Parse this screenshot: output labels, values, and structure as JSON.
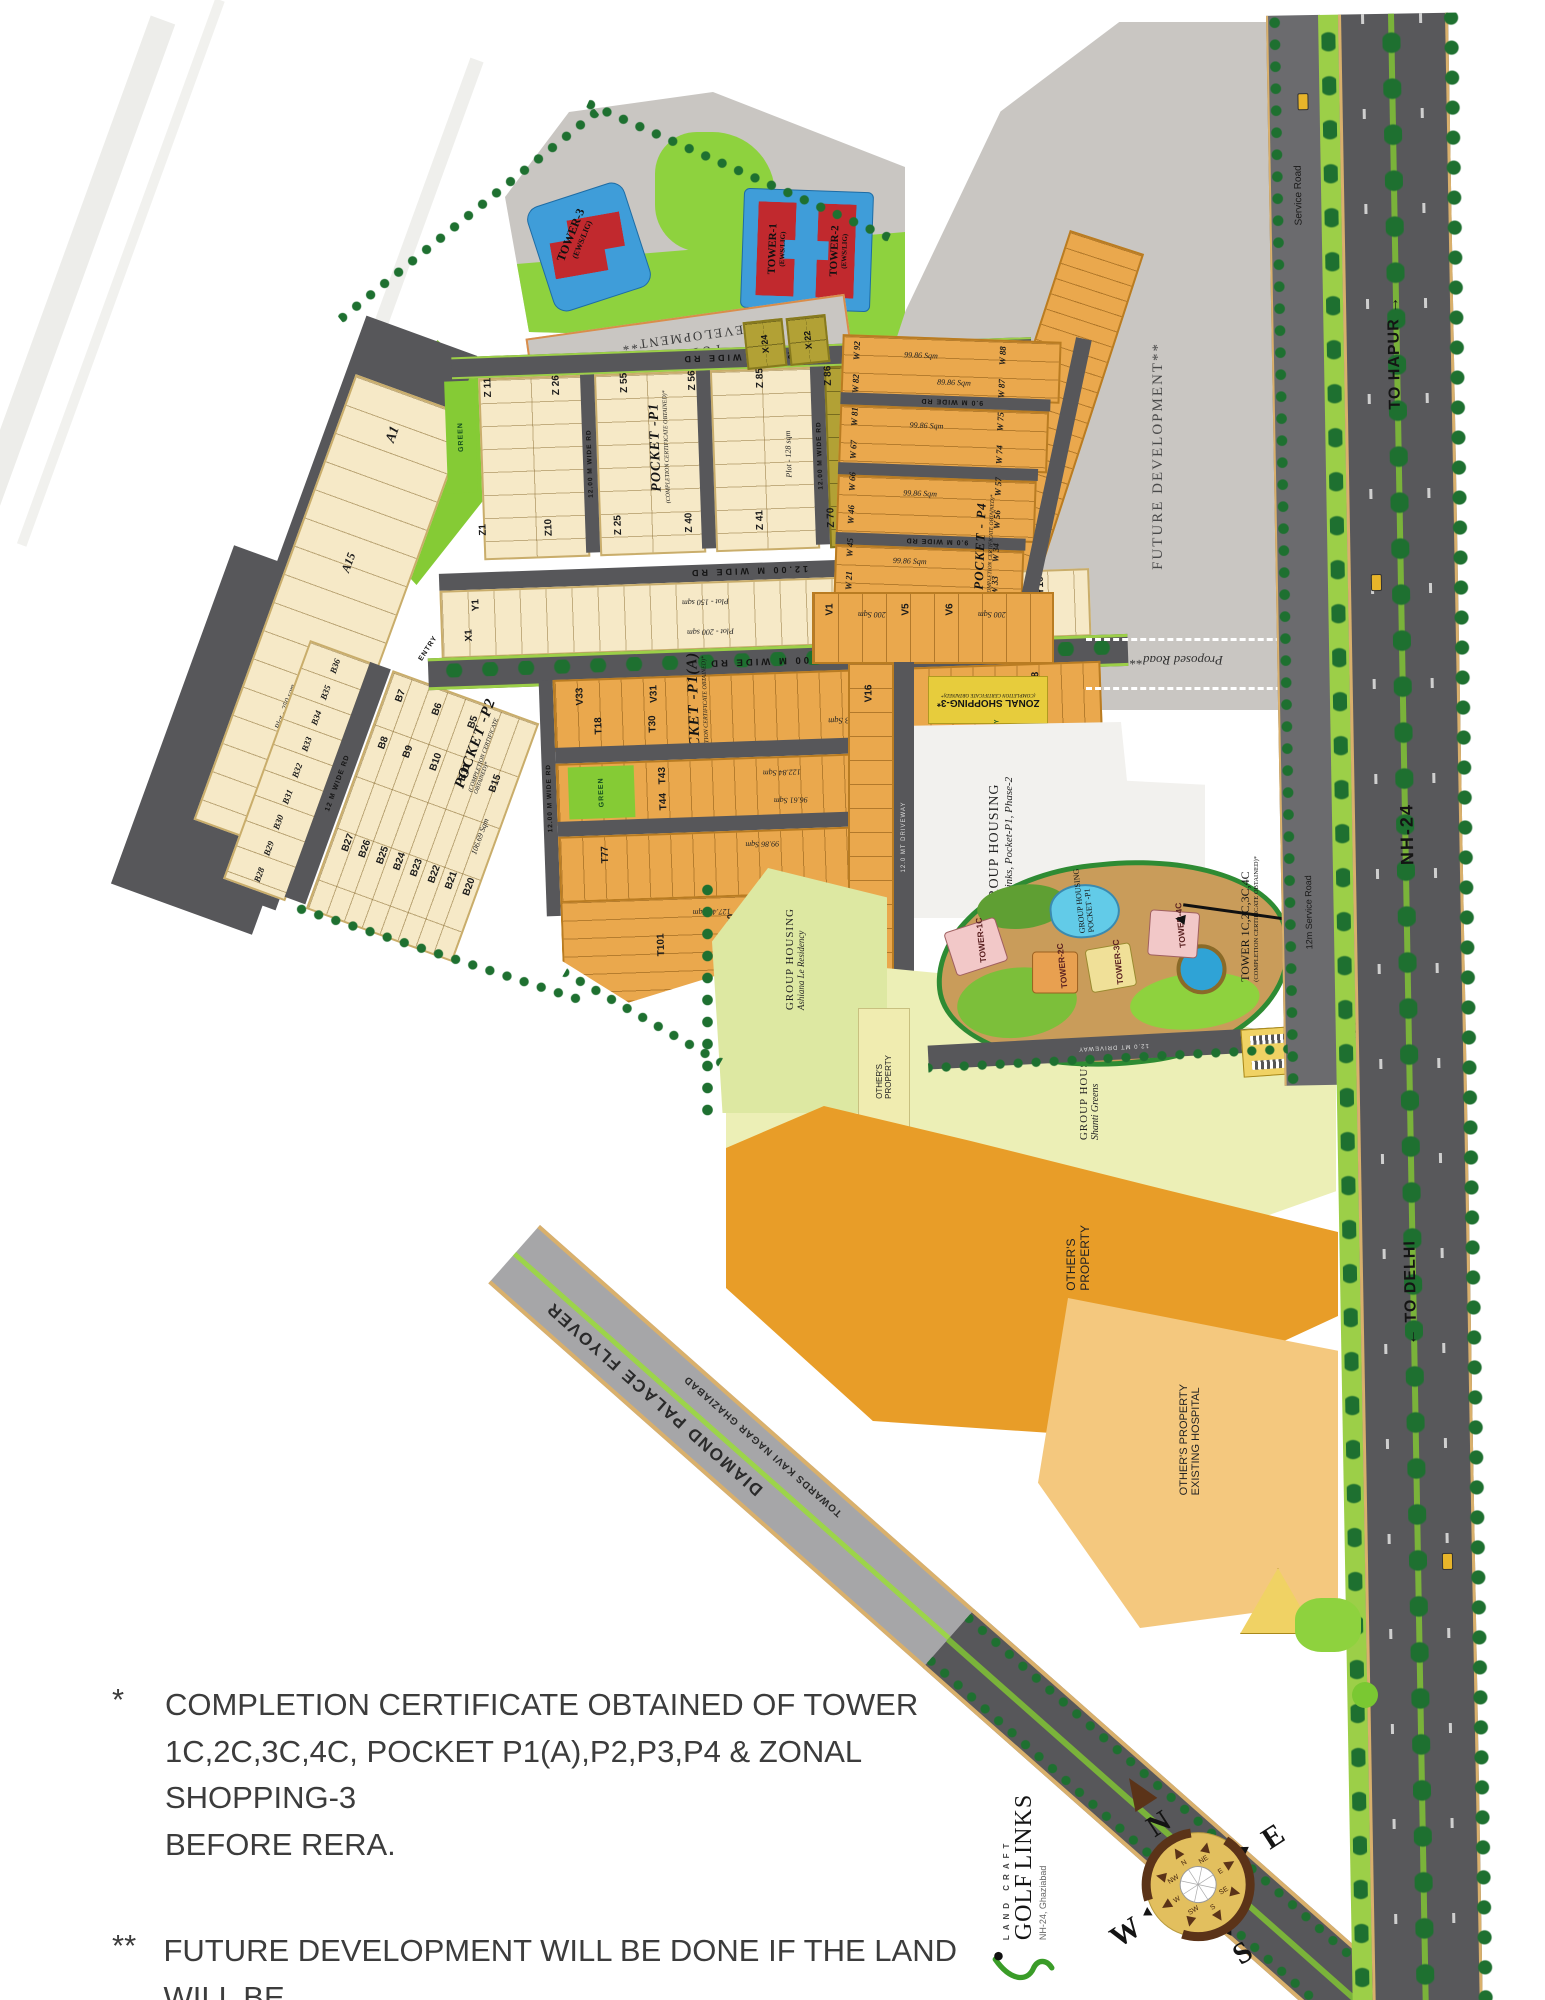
{
  "map": {
    "stp": "STP",
    "master_plan_road_line1": "MASTER PLAN ROAD",
    "master_plan_road_line2": "45 MT WIDE",
    "future_development_vertical": "FUTURE DEVELOPMENT**",
    "future_line1": "FUTURE",
    "future_line2": "DEVELOPMENT**",
    "green_label": "GREEN",
    "proposed_road": "Proposed Road**",
    "entry_main": "ENTRY",
    "entry_small": "ENTRY",
    "roads": {
      "rd12": "12.00 M WIDE RD",
      "rd24": "24.00 M WIDE RD",
      "rd9": "9.0 M WIDE RD",
      "rd12m": "12 M WIDE RD",
      "driveway": "12.0 MT DRIVEWAY",
      "nh24": "NH-24",
      "to_hapur": "TO HAPUR →",
      "to_delhi": "← TO DELHI",
      "service_road": "Service Road",
      "service_road_12m": "12m Service Road",
      "flyover_name": "DIAMOND PALACE FLYOVER",
      "flyover_towards": "TOWARDS KAVI NAGAR GHAZIABAD"
    },
    "towers_top": {
      "t3": "TOWER-3",
      "t1": "TOWER-1",
      "t2": "TOWER-2",
      "ews": "(EWS/LIG)"
    },
    "pockets": {
      "p1": "POCKET -P1",
      "p1a": "POCKET -P1(A)",
      "p2": "POCKET -P2",
      "p4": "POCKET - P4",
      "cc": "(COMPLETION CERTIFICATE OBTAINED)*"
    },
    "zonal": {
      "name": "ZONAL SHOPPING-3*",
      "cc": "(COMPLETION CERTIFICATE OBTAINED)*"
    },
    "group_housing": {
      "heading": "GROUP HOUSING",
      "golflinks": "Golflinks, Pocket-P1, Phase-2",
      "pocket_p1": "POCKET -P1",
      "ashiana": "Ashiana Le Residency",
      "shanti": "Shanti Greens"
    },
    "built_towers": {
      "t1c": "TOWER-1C",
      "t2c": "TOWER-2C",
      "t3c": "TOWER-3C",
      "t4c": "TOWER-4C",
      "cc_line1": "TOWER 1C,2C,3C,4C",
      "cc_line2": "(COMPLETION CERTIFICATE OBTAINED)*"
    },
    "others": {
      "line1": "OTHER'S",
      "line2": "PROPERTY",
      "combo1": "OTHER'S PROPERTY",
      "combo2": "EXISTING HOSPITAL"
    },
    "plots": {
      "a": [
        "A1",
        "A15"
      ],
      "z_top": [
        "Z 11",
        "Z 26",
        "Z 55",
        "Z 56",
        "Z 85",
        "Z 86",
        "Z 115",
        "Z 116"
      ],
      "z_bottom": [
        "Z1",
        "Z10",
        "Z 25",
        "Z 40",
        "Z 41",
        "Z 70",
        "Z 71",
        "Z 100"
      ],
      "x_small": [
        "X 24",
        "X 22"
      ],
      "w_left": [
        "W 92",
        "W 82",
        "W 81",
        "W 67",
        "W 66",
        "W 46",
        "W 45",
        "W 21"
      ],
      "w_right": [
        "W 88",
        "W 87",
        "W 75",
        "W 74",
        "W 57",
        "W 56",
        "W 34",
        "W 33"
      ],
      "b_col": [
        "B36",
        "B35",
        "B34",
        "B33",
        "B32",
        "B31",
        "B30",
        "B29",
        "B28"
      ],
      "b_top1": [
        "B7",
        "B6",
        "B5"
      ],
      "b_top2": [
        "B8",
        "B9",
        "B10",
        "B11",
        "B15"
      ],
      "b_bottom": [
        "B27",
        "B26",
        "B25",
        "B24",
        "B23",
        "B22",
        "B21",
        "B20"
      ]
    },
    "plot_labels": {
      "y1": "Y1",
      "x1": "X1",
      "y15": "Y15",
      "x16": "X16",
      "y16": "Y16",
      "x17": "X17",
      "v1": "V1",
      "v5": "V5",
      "v6": "V6",
      "v16": "V16",
      "v18": "V18",
      "v31": "V31",
      "v33": "V33",
      "t12": "T12",
      "t18": "T18",
      "t30": "T30",
      "t31": "T31",
      "t43": "T43",
      "t44": "T44",
      "t57": "T57",
      "t63": "T63",
      "t64": "T64",
      "t77": "T77",
      "t90": "T90",
      "t101": "T101"
    },
    "areas": {
      "plot250": "Plot - 250 sqm",
      "plot128": "Plot - 128 sqm",
      "plot150": "Plot - 150 sqm",
      "plot200": "Plot - 200 sqm",
      "s247": "247.37 Sqm",
      "s124": "124.63 Sqm",
      "s122": "122.84 Sqm",
      "s96": "96.61 Sqm",
      "s106": "106.69 Sqm",
      "s99": "99.86 Sqm",
      "s89": "89.86 Sqm",
      "s127": "127.47 Sqm",
      "s12437": "124.37 Sqm",
      "s200": "200 Sqm"
    }
  },
  "notes": {
    "marker1": "*",
    "n1_line1": "COMPLETION CERTIFICATE OBTAINED OF TOWER",
    "n1_line2": "1C,2C,3C,4C, POCKET P1(A),P2,P3,P4  & ZONAL SHOPPING-3",
    "n1_line3": "BEFORE RERA.",
    "marker2": "**",
    "n2_line1": "FUTURE DEVELOPMENT WILL BE DONE IF THE LAND WILL BE",
    "n2_line2": "PROVIDED TO LANDCRAFT DEVELOPERS PRIVATE LTD."
  },
  "logo": {
    "top": "LAND CRAFT",
    "name1": "GOLF",
    "name2": "LINKS",
    "sub": "NH-24, Ghaziabad"
  },
  "compass": {
    "n": "N",
    "e": "E",
    "s": "S",
    "w": "W",
    "inner": [
      "N",
      "NE",
      "E",
      "SE",
      "S",
      "SW",
      "W",
      "NW"
    ]
  },
  "colors": {
    "road": "#57575a",
    "plot_cream": "#f6e9c7",
    "plot_orange": "#eaa84d",
    "plot_olive": "#b2a135",
    "green_bright": "#85cb35",
    "green_tree": "#1e7030",
    "future_gray": "#c9c6c2",
    "stp_pink": "#f3b9c1",
    "zonal_yellow": "#e7cc3c",
    "tower_blue": "#3f9dd9",
    "tower_red": "#c1292e",
    "property_orange": "#e89d28",
    "hospital_tan": "#f4c87e",
    "pale_yellow": "#ecefb6"
  }
}
